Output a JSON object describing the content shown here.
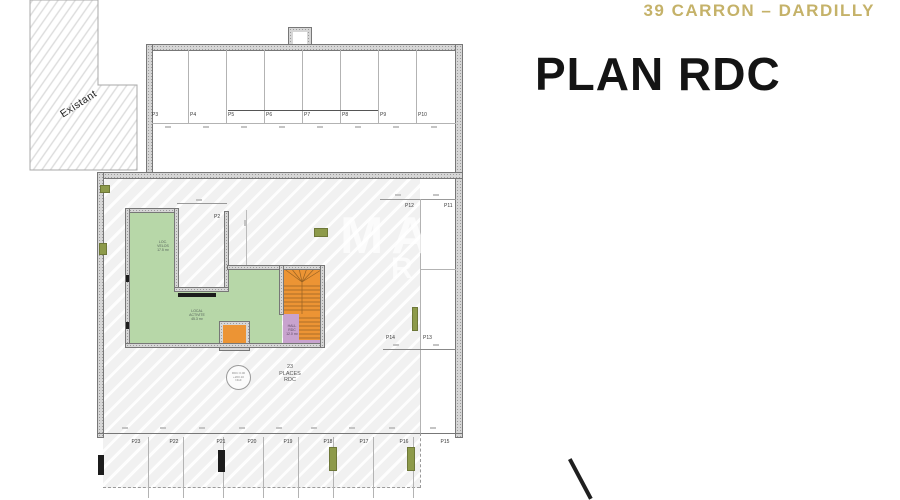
{
  "header": {
    "project_title": "39 CARRON – DARDILLY",
    "page_title": "PLAN RDC"
  },
  "plan": {
    "existing_area_label": "Existant",
    "top_row_spaces": [
      "P3",
      "P4",
      "P5",
      "P6",
      "P7",
      "P8",
      "P9",
      "P10"
    ],
    "inner_space_label": "P2",
    "right_top_spaces": [
      "P12",
      "P11"
    ],
    "right_mid_spaces": [
      "P14",
      "P13"
    ],
    "bottom_row_spaces": [
      "P23",
      "P22",
      "P21",
      "P20",
      "P19",
      "P18",
      "P17",
      "P16",
      "P15"
    ],
    "places_note": "23\nPLACES\nRDC",
    "level_marker": "RDC 0.00\n+200.10\nNGF",
    "room_labels": {
      "bike_room": "LOC.\nVELOS\n17.5 m²",
      "main_room": "LOCAL\nACTIVITE\n45.3 m²",
      "hall": "HALL\nRDC\n12.0 m²"
    },
    "watermark": {
      "line1": "MA",
      "line2": "R"
    },
    "colors": {
      "green": "#b7d7a8",
      "orange": "#ec9434",
      "purple": "#c8a3ce",
      "olive": "#8d9a4a",
      "gold": "#c4b169"
    }
  }
}
